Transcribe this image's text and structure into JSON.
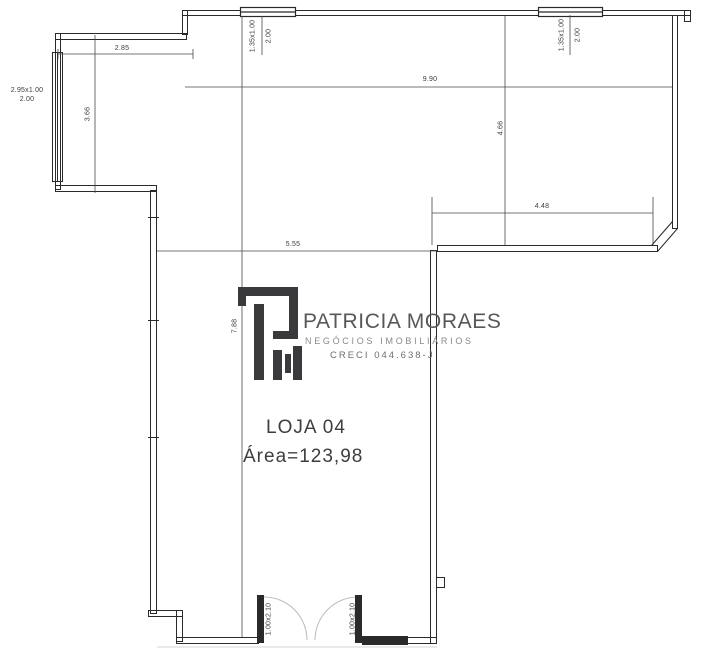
{
  "plan": {
    "room": {
      "name": "LOJA 04",
      "area": "Área=123,98"
    },
    "dimensions": {
      "top_left_width": "2.85",
      "bay_height": "3.66",
      "upper_width": "9.90",
      "upper_height": "4.66",
      "upper_right_width": "4.48",
      "lower_width": "5.55",
      "lower_height": "7.88"
    },
    "windows": {
      "bay": {
        "size": "2.95x1.00",
        "sill": "2.00"
      },
      "top_left": {
        "size": "1.35x1.00",
        "sill": "2.00"
      },
      "top_right": {
        "size": "1.35x1.00",
        "sill": "2.00"
      }
    },
    "doors": {
      "left": {
        "size": "1.00x2.10"
      },
      "right": {
        "size": "1.00x2.10"
      }
    }
  },
  "logo": {
    "name": "PATRICIA MORAES",
    "tagline": "NEGÓCIOS IMOBILIÁRIOS",
    "creci": "CRECI 044.638-J"
  },
  "colors": {
    "wall": "#2a2a2a",
    "dim": "#4a4a4a",
    "logo_dark": "#3a3a3c",
    "logo_text": "#58585a",
    "logo_sub": "#8a8a8a",
    "arc": "#bdbdbd",
    "bg": "#ffffff"
  }
}
